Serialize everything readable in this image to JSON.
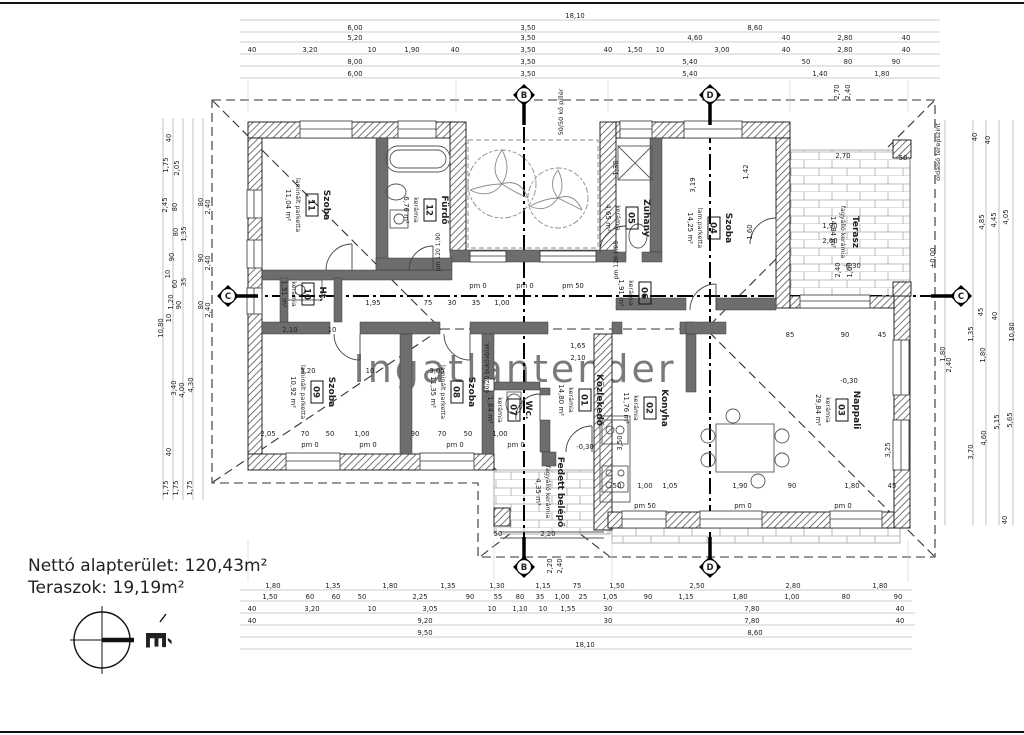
{
  "totals": {
    "line1": "Nettó alapterület:  120,43m²",
    "line2": "Teraszok: 19,19m²"
  },
  "north": {
    "label": "É"
  },
  "watermark": "Ingatlantender",
  "rooms": [
    {
      "num": "01",
      "name": "Közlekedő",
      "material": "kerámia",
      "area": "14,80 m²",
      "x": 583,
      "y": 400
    },
    {
      "num": "02",
      "name": "Konyha",
      "material": "kerámia",
      "area": "11,76 m²",
      "x": 648,
      "y": 408
    },
    {
      "num": "03",
      "name": "Nappali",
      "material": "kerámia",
      "area": "29,84 m²",
      "x": 840,
      "y": 410
    },
    {
      "num": "04",
      "name": "Szoba",
      "material": "lam.parketta",
      "area": "14,25 m²",
      "x": 712,
      "y": 228
    },
    {
      "num": "05",
      "name": "Zuhany",
      "material": "kerámia",
      "area": "4,65 m²",
      "x": 630,
      "y": 218
    },
    {
      "num": "06",
      "name": "",
      "material": "kerámia",
      "area": "1,91 m²",
      "x": 643,
      "y": 293
    },
    {
      "num": "07",
      "name": "Wc.",
      "material": "kerámia",
      "area": "1,64 m²",
      "x": 512,
      "y": 410
    },
    {
      "num": "08",
      "name": "Szoba",
      "material": "laminált parketta",
      "area": "11,35 m²",
      "x": 455,
      "y": 392
    },
    {
      "num": "09",
      "name": "Szoba",
      "material": "laminált parketta",
      "area": "10,92 m²",
      "x": 315,
      "y": 392
    },
    {
      "num": "10",
      "name": "Ht.",
      "material": "kerámia",
      "area": "1,51 m²",
      "x": 306,
      "y": 294
    },
    {
      "num": "11",
      "name": "Szoba",
      "material": "laminált parketta",
      "area": "11,04 m²",
      "x": 310,
      "y": 205
    },
    {
      "num": "12",
      "name": "Fürdő",
      "material": "kerámia",
      "area": "6,76 m²",
      "x": 428,
      "y": 210
    },
    {
      "num": "",
      "name": "Terasz",
      "material": "fagyálló kerámia",
      "area": "14,84 m²",
      "x": 847,
      "y": 232
    },
    {
      "num": "",
      "name": "Fedett belépő",
      "material": "fagyálló kerámia",
      "area": "4,35 m²",
      "x": 552,
      "y": 492
    }
  ],
  "markers": [
    {
      "letter": "B",
      "x": 524,
      "y": 95,
      "dir": "down"
    },
    {
      "letter": "D",
      "x": 710,
      "y": 95,
      "dir": "down"
    },
    {
      "letter": "B",
      "x": 524,
      "y": 567,
      "dir": "up"
    },
    {
      "letter": "D",
      "x": 710,
      "y": 567,
      "dir": "up"
    },
    {
      "letter": "C",
      "x": 228,
      "y": 296,
      "dir": "right"
    },
    {
      "letter": "C",
      "x": 961,
      "y": 296,
      "dir": "left"
    }
  ],
  "annotations": [
    {
      "x": 940,
      "y": 152,
      "t": "oldalsó terepszint",
      "r": 1,
      "s": 6.5
    },
    {
      "x": 935,
      "y": 258,
      "t": "±0,00",
      "r": 1
    },
    {
      "x": 563,
      "y": 112,
      "t": "50/50 kő pillér",
      "r": 1,
      "s": 6.5
    },
    {
      "x": 489,
      "y": 368,
      "t": "60/20 bukóablak",
      "r": 1,
      "s": 6
    },
    {
      "x": 852,
      "y": 268,
      "t": "-0,30"
    },
    {
      "x": 849,
      "y": 383,
      "t": "-0,30"
    },
    {
      "x": 585,
      "y": 449,
      "t": "-0,30"
    },
    {
      "x": 310,
      "y": 447,
      "t": "pm 0"
    },
    {
      "x": 368,
      "y": 447,
      "t": "pm 0"
    },
    {
      "x": 455,
      "y": 447,
      "t": "pm 0"
    },
    {
      "x": 516,
      "y": 447,
      "t": "pm 0"
    },
    {
      "x": 478,
      "y": 288,
      "t": "pm 0"
    },
    {
      "x": 525,
      "y": 288,
      "t": "pm 0"
    },
    {
      "x": 573,
      "y": 288,
      "t": "pm 50"
    },
    {
      "x": 645,
      "y": 508,
      "t": "pm 50"
    },
    {
      "x": 743,
      "y": 508,
      "t": "pm 0"
    },
    {
      "x": 843,
      "y": 508,
      "t": "pm 0"
    },
    {
      "x": 618,
      "y": 260,
      "t": "pm 120 1,05",
      "r": 1,
      "s": 6
    },
    {
      "x": 440,
      "y": 252,
      "t": "pm 120 1,90",
      "r": 1,
      "s": 6
    }
  ],
  "dimensions": {
    "labels": [
      {
        "x": 575,
        "y": 18,
        "t": "18,10"
      },
      {
        "x": 355,
        "y": 30,
        "t": "6,00"
      },
      {
        "x": 528,
        "y": 30,
        "t": "3,50"
      },
      {
        "x": 755,
        "y": 30,
        "t": "8,60"
      },
      {
        "x": 355,
        "y": 40,
        "t": "5,20"
      },
      {
        "x": 528,
        "y": 40,
        "t": "3,50"
      },
      {
        "x": 695,
        "y": 40,
        "t": "4,60"
      },
      {
        "x": 786,
        "y": 40,
        "t": "40"
      },
      {
        "x": 845,
        "y": 40,
        "t": "2,80"
      },
      {
        "x": 906,
        "y": 40,
        "t": "40"
      },
      {
        "x": 252,
        "y": 52,
        "t": "40"
      },
      {
        "x": 310,
        "y": 52,
        "t": "3,20"
      },
      {
        "x": 372,
        "y": 52,
        "t": "10"
      },
      {
        "x": 412,
        "y": 52,
        "t": "1,90"
      },
      {
        "x": 455,
        "y": 52,
        "t": "40"
      },
      {
        "x": 528,
        "y": 52,
        "t": "3,50"
      },
      {
        "x": 608,
        "y": 52,
        "t": "40"
      },
      {
        "x": 635,
        "y": 52,
        "t": "1,50"
      },
      {
        "x": 660,
        "y": 52,
        "t": "10"
      },
      {
        "x": 722,
        "y": 52,
        "t": "3,00"
      },
      {
        "x": 786,
        "y": 52,
        "t": "40"
      },
      {
        "x": 845,
        "y": 52,
        "t": "2,80"
      },
      {
        "x": 906,
        "y": 52,
        "t": "40"
      },
      {
        "x": 355,
        "y": 64,
        "t": "8,00"
      },
      {
        "x": 528,
        "y": 64,
        "t": "3,50"
      },
      {
        "x": 690,
        "y": 64,
        "t": "5,40"
      },
      {
        "x": 806,
        "y": 64,
        "t": "50"
      },
      {
        "x": 848,
        "y": 64,
        "t": "80"
      },
      {
        "x": 896,
        "y": 64,
        "t": "90"
      },
      {
        "x": 355,
        "y": 76,
        "t": "6,00"
      },
      {
        "x": 528,
        "y": 76,
        "t": "3,50"
      },
      {
        "x": 690,
        "y": 76,
        "t": "5,40"
      },
      {
        "x": 820,
        "y": 76,
        "t": "1,40"
      },
      {
        "x": 882,
        "y": 76,
        "t": "1,80"
      },
      {
        "x": 839,
        "y": 92,
        "t": "2,70",
        "r": 1
      },
      {
        "x": 850,
        "y": 92,
        "t": "2,40",
        "r": 1
      },
      {
        "x": 273,
        "y": 588,
        "t": "1,80"
      },
      {
        "x": 333,
        "y": 588,
        "t": "1,35"
      },
      {
        "x": 390,
        "y": 588,
        "t": "1,80"
      },
      {
        "x": 448,
        "y": 588,
        "t": "1,35"
      },
      {
        "x": 497,
        "y": 588,
        "t": "1,30"
      },
      {
        "x": 543,
        "y": 588,
        "t": "1,15"
      },
      {
        "x": 577,
        "y": 588,
        "t": "75"
      },
      {
        "x": 617,
        "y": 588,
        "t": "1,50"
      },
      {
        "x": 697,
        "y": 588,
        "t": "2,50"
      },
      {
        "x": 793,
        "y": 588,
        "t": "2,80"
      },
      {
        "x": 880,
        "y": 588,
        "t": "1,80"
      },
      {
        "x": 270,
        "y": 599,
        "t": "1,50"
      },
      {
        "x": 310,
        "y": 599,
        "t": "60"
      },
      {
        "x": 336,
        "y": 599,
        "t": "60"
      },
      {
        "x": 362,
        "y": 599,
        "t": "50"
      },
      {
        "x": 420,
        "y": 599,
        "t": "2,25"
      },
      {
        "x": 470,
        "y": 599,
        "t": "90"
      },
      {
        "x": 498,
        "y": 599,
        "t": "55"
      },
      {
        "x": 520,
        "y": 599,
        "t": "80"
      },
      {
        "x": 540,
        "y": 599,
        "t": "35"
      },
      {
        "x": 562,
        "y": 599,
        "t": "1,00"
      },
      {
        "x": 583,
        "y": 599,
        "t": "25"
      },
      {
        "x": 610,
        "y": 599,
        "t": "1,05"
      },
      {
        "x": 648,
        "y": 599,
        "t": "90"
      },
      {
        "x": 686,
        "y": 599,
        "t": "1,15"
      },
      {
        "x": 740,
        "y": 599,
        "t": "1,80"
      },
      {
        "x": 792,
        "y": 599,
        "t": "1,00"
      },
      {
        "x": 846,
        "y": 599,
        "t": "80"
      },
      {
        "x": 898,
        "y": 599,
        "t": "90"
      },
      {
        "x": 252,
        "y": 611,
        "t": "40"
      },
      {
        "x": 312,
        "y": 611,
        "t": "3,20"
      },
      {
        "x": 372,
        "y": 611,
        "t": "10"
      },
      {
        "x": 430,
        "y": 611,
        "t": "3,05"
      },
      {
        "x": 492,
        "y": 611,
        "t": "10"
      },
      {
        "x": 520,
        "y": 611,
        "t": "1,10"
      },
      {
        "x": 543,
        "y": 611,
        "t": "10"
      },
      {
        "x": 568,
        "y": 611,
        "t": "1,55"
      },
      {
        "x": 608,
        "y": 611,
        "t": "30"
      },
      {
        "x": 752,
        "y": 611,
        "t": "7,80"
      },
      {
        "x": 900,
        "y": 611,
        "t": "40"
      },
      {
        "x": 252,
        "y": 623,
        "t": "40"
      },
      {
        "x": 425,
        "y": 623,
        "t": "9,20"
      },
      {
        "x": 608,
        "y": 623,
        "t": "30"
      },
      {
        "x": 752,
        "y": 623,
        "t": "7,80"
      },
      {
        "x": 900,
        "y": 623,
        "t": "40"
      },
      {
        "x": 425,
        "y": 635,
        "t": "9,50"
      },
      {
        "x": 755,
        "y": 635,
        "t": "8,60"
      },
      {
        "x": 585,
        "y": 647,
        "t": "18,10"
      },
      {
        "x": 163,
        "y": 328,
        "t": "10,80",
        "r": 1
      },
      {
        "x": 171,
        "y": 138,
        "t": "40",
        "r": 1
      },
      {
        "x": 168,
        "y": 165,
        "t": "1,75",
        "r": 1
      },
      {
        "x": 179,
        "y": 168,
        "t": "2,05",
        "r": 1
      },
      {
        "x": 167,
        "y": 205,
        "t": "2,45",
        "r": 1
      },
      {
        "x": 177,
        "y": 207,
        "t": "80",
        "r": 1
      },
      {
        "x": 178,
        "y": 232,
        "t": "80",
        "r": 1
      },
      {
        "x": 186,
        "y": 234,
        "t": "1,35",
        "r": 1
      },
      {
        "x": 174,
        "y": 257,
        "t": "90",
        "r": 1
      },
      {
        "x": 170,
        "y": 274,
        "t": "10",
        "r": 1
      },
      {
        "x": 177,
        "y": 284,
        "t": "60",
        "r": 1
      },
      {
        "x": 186,
        "y": 282,
        "t": "35",
        "r": 1
      },
      {
        "x": 173,
        "y": 302,
        "t": "1,20",
        "r": 1
      },
      {
        "x": 181,
        "y": 305,
        "t": "90",
        "r": 1
      },
      {
        "x": 171,
        "y": 318,
        "t": "10",
        "r": 1
      },
      {
        "x": 176,
        "y": 388,
        "t": "3,40",
        "r": 1
      },
      {
        "x": 184,
        "y": 390,
        "t": "4,00",
        "r": 1
      },
      {
        "x": 193,
        "y": 385,
        "t": "4,30",
        "r": 1
      },
      {
        "x": 171,
        "y": 452,
        "t": "40",
        "r": 1
      },
      {
        "x": 168,
        "y": 488,
        "t": "1,75",
        "r": 1
      },
      {
        "x": 178,
        "y": 488,
        "t": "1,75",
        "r": 1
      },
      {
        "x": 192,
        "y": 488,
        "t": "1,75",
        "r": 1
      },
      {
        "x": 203,
        "y": 202,
        "t": "80",
        "r": 1
      },
      {
        "x": 210,
        "y": 207,
        "t": "2,40",
        "r": 1
      },
      {
        "x": 203,
        "y": 258,
        "t": "90",
        "r": 1
      },
      {
        "x": 210,
        "y": 263,
        "t": "2,40",
        "r": 1
      },
      {
        "x": 203,
        "y": 305,
        "t": "80",
        "r": 1
      },
      {
        "x": 210,
        "y": 310,
        "t": "2,40",
        "r": 1
      },
      {
        "x": 1014,
        "y": 332,
        "t": "10,80",
        "r": 1
      },
      {
        "x": 977,
        "y": 137,
        "t": "40",
        "r": 1
      },
      {
        "x": 990,
        "y": 140,
        "t": "40",
        "r": 1
      },
      {
        "x": 1008,
        "y": 217,
        "t": "4,05",
        "r": 1
      },
      {
        "x": 996,
        "y": 220,
        "t": "4,45",
        "r": 1
      },
      {
        "x": 984,
        "y": 222,
        "t": "4,85",
        "r": 1
      },
      {
        "x": 983,
        "y": 312,
        "t": "45",
        "r": 1
      },
      {
        "x": 997,
        "y": 316,
        "t": "40",
        "r": 1
      },
      {
        "x": 973,
        "y": 334,
        "t": "1,35",
        "r": 1
      },
      {
        "x": 985,
        "y": 355,
        "t": "1,80",
        "r": 1
      },
      {
        "x": 945,
        "y": 354,
        "t": "1,80",
        "r": 1
      },
      {
        "x": 951,
        "y": 365,
        "t": "2,40",
        "r": 1
      },
      {
        "x": 1012,
        "y": 420,
        "t": "5,65",
        "r": 1
      },
      {
        "x": 999,
        "y": 422,
        "t": "5,15",
        "r": 1
      },
      {
        "x": 986,
        "y": 438,
        "t": "4,60",
        "r": 1
      },
      {
        "x": 973,
        "y": 452,
        "t": "3,70",
        "r": 1
      },
      {
        "x": 1007,
        "y": 520,
        "t": "40",
        "r": 1
      },
      {
        "x": 373,
        "y": 305,
        "t": "1,95"
      },
      {
        "x": 428,
        "y": 305,
        "t": "75"
      },
      {
        "x": 452,
        "y": 305,
        "t": "30"
      },
      {
        "x": 476,
        "y": 305,
        "t": "35"
      },
      {
        "x": 502,
        "y": 305,
        "t": "1,00"
      },
      {
        "x": 290,
        "y": 332,
        "t": "2,10"
      },
      {
        "x": 332,
        "y": 332,
        "t": "10"
      },
      {
        "x": 308,
        "y": 373,
        "t": "3,20"
      },
      {
        "x": 370,
        "y": 373,
        "t": "10"
      },
      {
        "x": 437,
        "y": 373,
        "t": "3,05"
      },
      {
        "x": 268,
        "y": 436,
        "t": "2,05"
      },
      {
        "x": 305,
        "y": 436,
        "t": "70"
      },
      {
        "x": 330,
        "y": 436,
        "t": "50"
      },
      {
        "x": 362,
        "y": 436,
        "t": "1,00"
      },
      {
        "x": 415,
        "y": 436,
        "t": "90"
      },
      {
        "x": 442,
        "y": 436,
        "t": "70"
      },
      {
        "x": 468,
        "y": 436,
        "t": "50"
      },
      {
        "x": 500,
        "y": 436,
        "t": "1,00"
      },
      {
        "x": 618,
        "y": 168,
        "t": "1,30",
        "r": 1
      },
      {
        "x": 695,
        "y": 185,
        "t": "3,19",
        "r": 1
      },
      {
        "x": 748,
        "y": 172,
        "t": "1,42",
        "r": 1
      },
      {
        "x": 752,
        "y": 232,
        "t": "1,60",
        "r": 1
      },
      {
        "x": 830,
        "y": 228,
        "t": "1,90"
      },
      {
        "x": 830,
        "y": 243,
        "t": "2,60"
      },
      {
        "x": 843,
        "y": 158,
        "t": "2,70"
      },
      {
        "x": 903,
        "y": 160,
        "t": "50"
      },
      {
        "x": 840,
        "y": 270,
        "t": "2,40",
        "r": 1
      },
      {
        "x": 852,
        "y": 270,
        "t": "1,60",
        "r": 1
      },
      {
        "x": 790,
        "y": 337,
        "t": "85"
      },
      {
        "x": 845,
        "y": 337,
        "t": "90"
      },
      {
        "x": 882,
        "y": 337,
        "t": "45"
      },
      {
        "x": 890,
        "y": 450,
        "t": "3,25",
        "r": 1
      },
      {
        "x": 740,
        "y": 488,
        "t": "1,90"
      },
      {
        "x": 792,
        "y": 488,
        "t": "90"
      },
      {
        "x": 852,
        "y": 488,
        "t": "1,80"
      },
      {
        "x": 892,
        "y": 488,
        "t": "45"
      },
      {
        "x": 617,
        "y": 488,
        "t": "50"
      },
      {
        "x": 645,
        "y": 488,
        "t": "1,00"
      },
      {
        "x": 670,
        "y": 488,
        "t": "1,05"
      },
      {
        "x": 622,
        "y": 443,
        "t": "3,50",
        "r": 1
      },
      {
        "x": 578,
        "y": 348,
        "t": "1,65"
      },
      {
        "x": 578,
        "y": 360,
        "t": "2,10"
      },
      {
        "x": 498,
        "y": 536,
        "t": "50"
      },
      {
        "x": 548,
        "y": 536,
        "t": "2,20"
      },
      {
        "x": 552,
        "y": 566,
        "t": "2,20",
        "r": 1
      },
      {
        "x": 562,
        "y": 566,
        "t": "2,40",
        "r": 1
      }
    ]
  }
}
